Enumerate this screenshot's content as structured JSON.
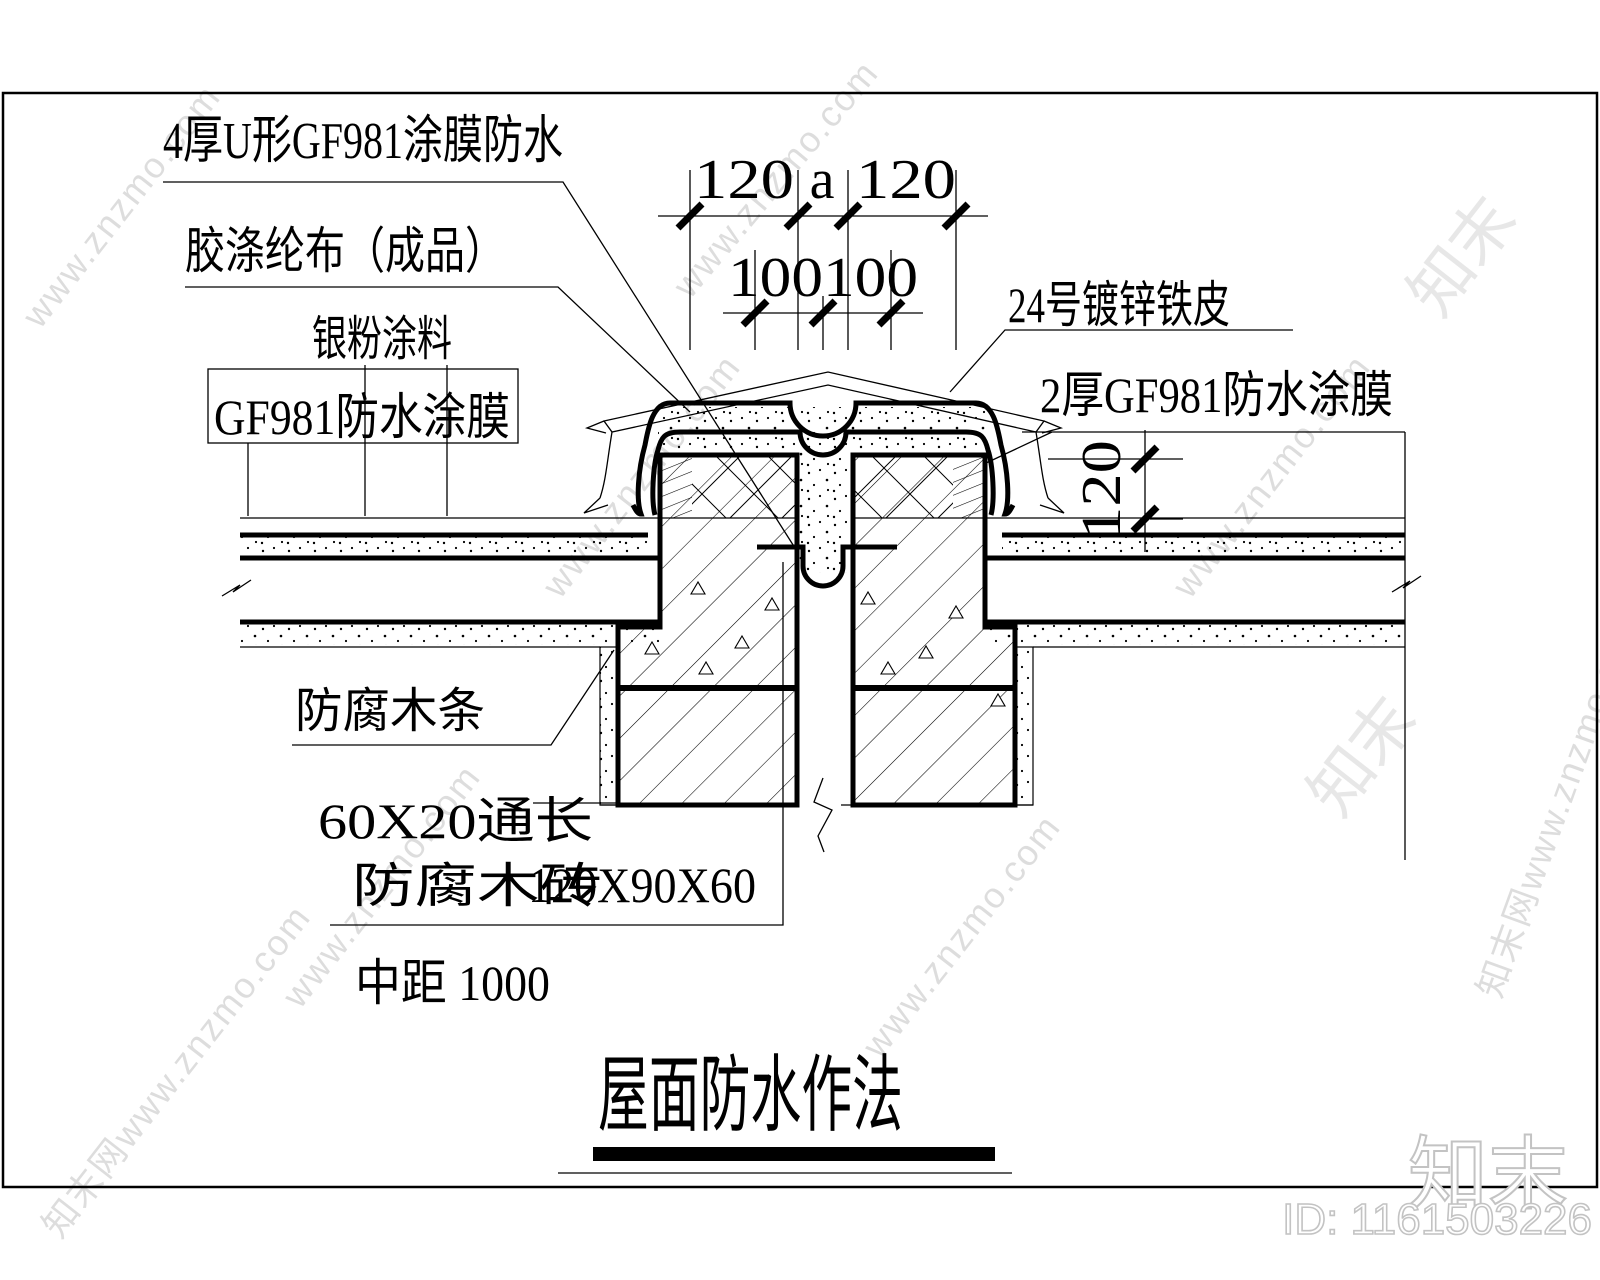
{
  "meta": {
    "background": "#ffffff",
    "ink": "#000000",
    "watermark_color": "#d8d8d8"
  },
  "title": {
    "text": "屋面防水作法"
  },
  "annotations": {
    "top_membrane": "4厚U形GF981涂膜防水",
    "cloth": "胶涤纶布（成品）",
    "silver_paint": "银粉涂料",
    "gf981_membrane": "GF981防水涂膜",
    "steel_sheet": "24号镀锌铁皮",
    "membrane_2mm": "2厚GF981防水涂膜",
    "wood_strip": "防腐木条",
    "wood_batten": "60X20通长",
    "wood_brick": "防腐木砖",
    "block_size": "120X90X60",
    "spacing": "中距 1000"
  },
  "dimensions": {
    "d_left_120": "120",
    "d_a": "a",
    "d_right_120": "120",
    "d_100_100": "100100",
    "d_vert_120": "120"
  },
  "watermark": {
    "site": "www.znzmo.com",
    "brand_site": "知末网www.znzmo.com",
    "brand": "知末",
    "id_label": "ID: 1161503226"
  }
}
